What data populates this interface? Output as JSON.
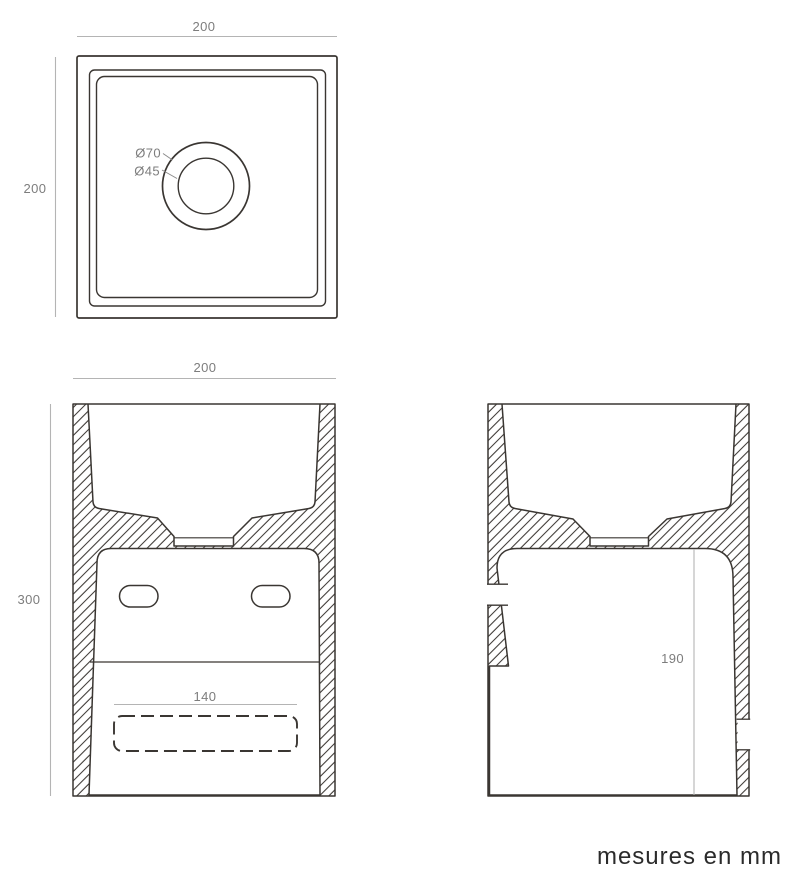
{
  "caption": "mesures en mm",
  "top_view": {
    "width_dim": "200",
    "height_dim": "200",
    "drain_outer_dia": "Ø70",
    "drain_inner_dia": "Ø45"
  },
  "front_view": {
    "width_dim": "200",
    "height_dim": "300",
    "slot_dim": "140"
  },
  "side_view": {
    "recess_dim": "190"
  },
  "colors": {
    "outline": "#3a3632",
    "dimension_line": "#b4b4b4",
    "dimension_text": "#7d7d7d",
    "caption_text": "#2b2b2b"
  }
}
